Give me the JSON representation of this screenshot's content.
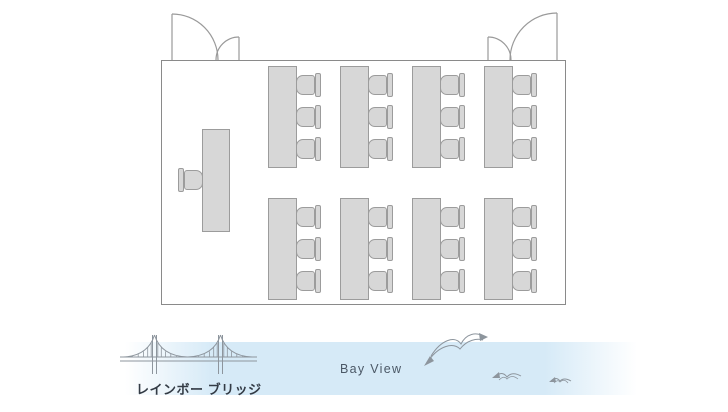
{
  "labels": {
    "bay_view": "Bay View",
    "bridge_name": "レインボー ブリッジ"
  },
  "floor_plan": {
    "type": "classroom-style seating plan",
    "table_rows": 2,
    "table_columns": 4,
    "chairs_per_table": 3,
    "total_tables": 8,
    "total_seats": 24,
    "head_table": {
      "count": 1,
      "chairs": 1
    },
    "double_doors": 2
  },
  "icons": [
    "double-door-left-icon",
    "double-door-right-icon",
    "suspension-bridge-icon",
    "seagull-icon"
  ],
  "colors": {
    "furniture_fill": "#d7d7d7",
    "furniture_border": "#9c9c9c",
    "wall": "#8a8a8a",
    "door_line": "#9a9a9a",
    "sketch_line": "#8d959d",
    "bay_band": "#d6eaf7",
    "bay_text": "#4b5866",
    "bridge_text": "#333b45"
  }
}
